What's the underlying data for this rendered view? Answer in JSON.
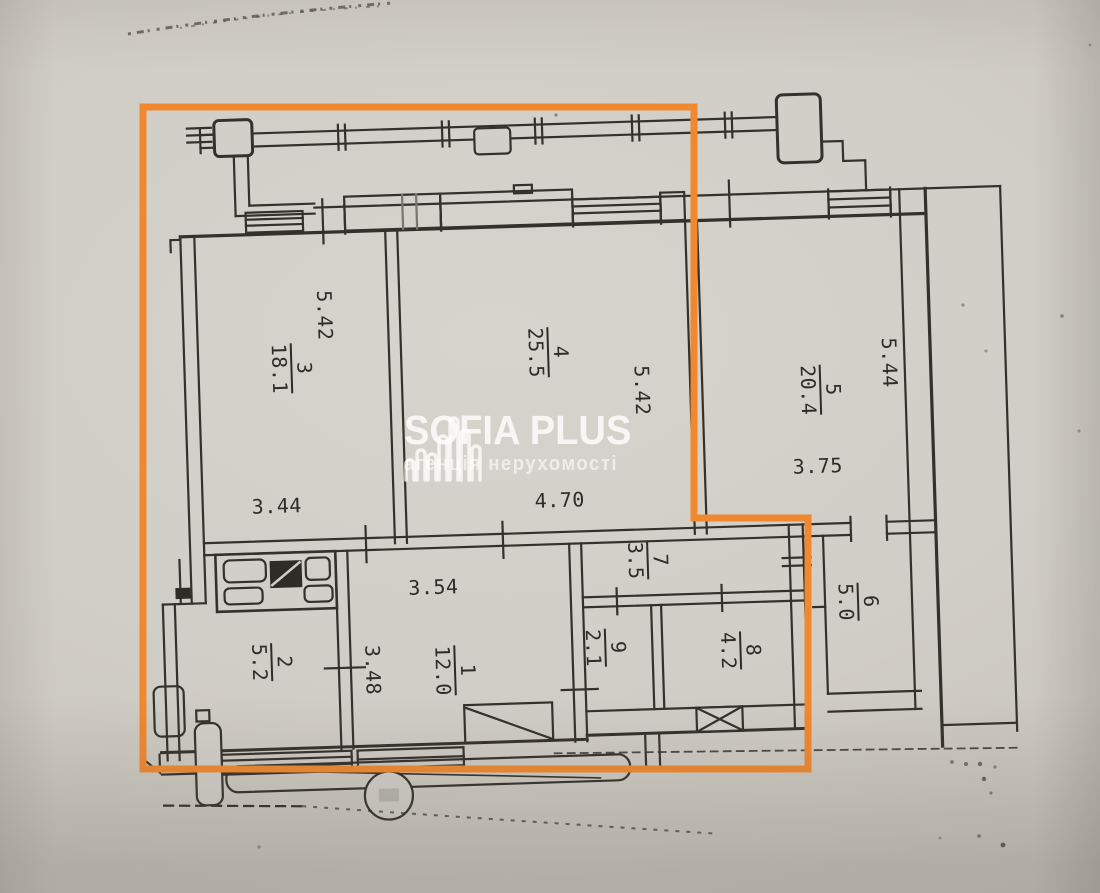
{
  "watermark": {
    "title": "SOFIA PLUS",
    "subtitle": "агенція нерухомості",
    "icon": "building-bars-icon"
  },
  "highlight_color": "#f0882f",
  "ink_color": "#33312b",
  "rooms": [
    {
      "number": "1",
      "area": "12.0"
    },
    {
      "number": "2",
      "area": "5.2"
    },
    {
      "number": "3",
      "area": "18.1"
    },
    {
      "number": "4",
      "area": "25.5"
    },
    {
      "number": "5",
      "area": "20.4"
    },
    {
      "number": "6",
      "area": "5.0"
    },
    {
      "number": "7",
      "area": "3.5"
    },
    {
      "number": "8",
      "area": "4.2"
    },
    {
      "number": "9",
      "area": "2.1"
    }
  ],
  "dimensions": {
    "room3_depth": "5.42",
    "room4_depth": "5.42",
    "room5_depth": "5.44",
    "room3_width": "3.44",
    "room4_width": "4.70",
    "room5_width": "3.75",
    "room1_width": "3.54",
    "room1_depth": "3.48"
  }
}
